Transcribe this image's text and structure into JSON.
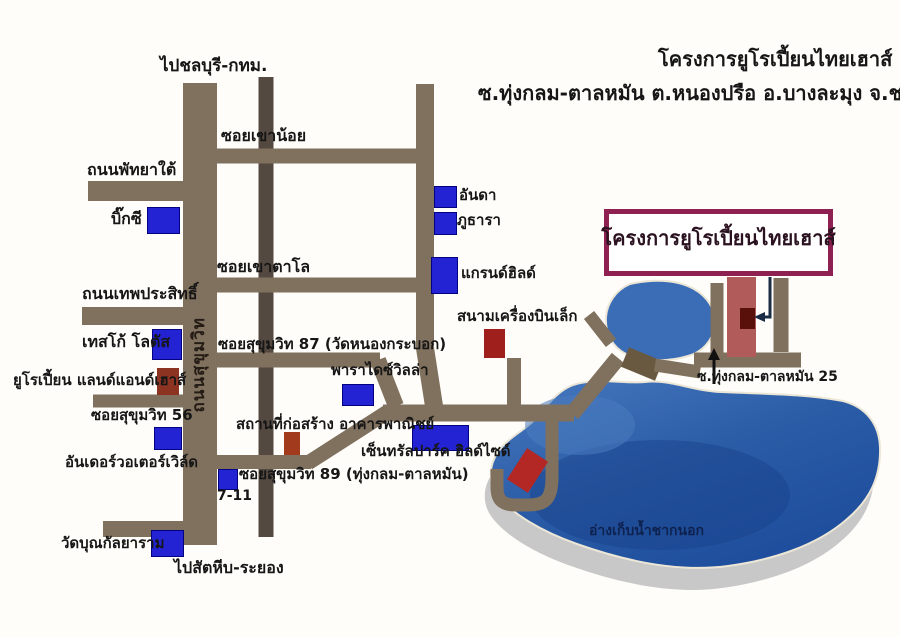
{
  "header": {
    "title_line1": "โครงการยูโรเปี้ยนไทยเฮาส์",
    "title_line2": "ซ.ทุ่งกลม-ตาลหมัน ต.หนองปรือ อ.บางละมุง จ.ชลบุรี"
  },
  "project_sign": {
    "label": "โครงการยูโรเปี้ยนไทยเฮาส์"
  },
  "roads": {
    "sukhumvit_vertical_label": "ถนนสุขุมวิท",
    "to_chonburi_bkk": "ไปชลบุรี-กทม.",
    "to_sattahip_rayong": "ไปสัตหีบ-ระยอง",
    "south_pattaya": "ถนนพัทยาใต้",
    "soi_khao_noi": "ซอยเขาน้อย",
    "soi_khao_talo": "ซอยเขาตาโล",
    "thepprasit": "ถนนเทพประสิทธิ์",
    "soi_sukhumvit_87": "ซอยสุขุมวิท 87 (วัดหนองกระบอก)",
    "soi_sukhumvit_56": "ซอยสุขุมวิท 56",
    "soi_sukhumvit_89": "ซอยสุขุมวิท 89 (ทุ่งกลม-ตาลหมัน)",
    "soi_thung_klom_25": "ซ.ทุ่งกลม-ตาลหมัน 25"
  },
  "landmarks": {
    "big_c": "บิ๊กซี",
    "tesco_lotus": "เทสโก้ โลตัส",
    "anda": "อันดา",
    "phuthara": "ภูธารา",
    "grand_hill": "แกรนด์ฮิลด์",
    "small_airfield": "สนามเครื่องบินเล็ก",
    "paradise_villa": "พาราไดซ์วิลล่า",
    "european_land_and_house": "ยูโรเปี้ยน แลนด์แอนด์เฮาส์",
    "construction_site": "สถานที่ก่อสร้าง อาคารพาณิชย์",
    "underwater_world": "อันเดอร์วอเตอร์เวิล์ด",
    "central_park_hillside": "เซ็นทรัลปาร์ค ฮิลด์ไซด์",
    "seven_eleven": "7-11",
    "wat_bun_kanlayaram": "วัดบุณกัลยาราม",
    "chak_nok_reservoir": "อ่างเก็บน้ำชากนอก"
  },
  "colors": {
    "road": "#80705e",
    "road_dark": "#544940",
    "bridge": "#6a5941",
    "landmark_blue": "#2323d4",
    "landmark_red": "#9e241c",
    "project_strip": "#b25b5b",
    "project_unit": "#5a100a",
    "sign_border": "#8e2052",
    "lake_blue": "#2b5ca6",
    "lake_shadow": "#c8c8c8"
  }
}
